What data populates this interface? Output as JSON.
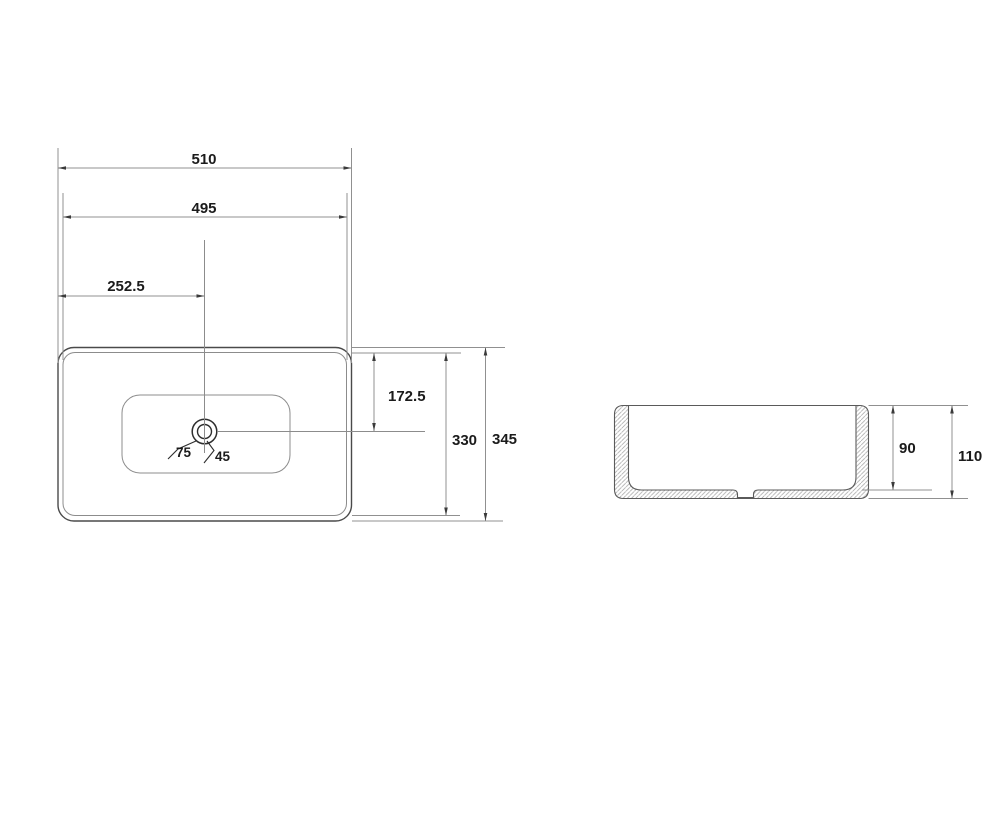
{
  "drawing": {
    "type": "basin-technical-drawing",
    "views": {
      "top": {
        "dim_width_outer": "510",
        "dim_width_rim": "495",
        "dim_center_x": "252.5",
        "dim_drain_y": "172.5",
        "dim_depth_rim": "330",
        "dim_depth_outer": "345",
        "label_drain_outer": "75",
        "label_drain_inner": "45"
      },
      "section": {
        "dim_inner_height": "90",
        "dim_total_height": "110"
      }
    }
  }
}
